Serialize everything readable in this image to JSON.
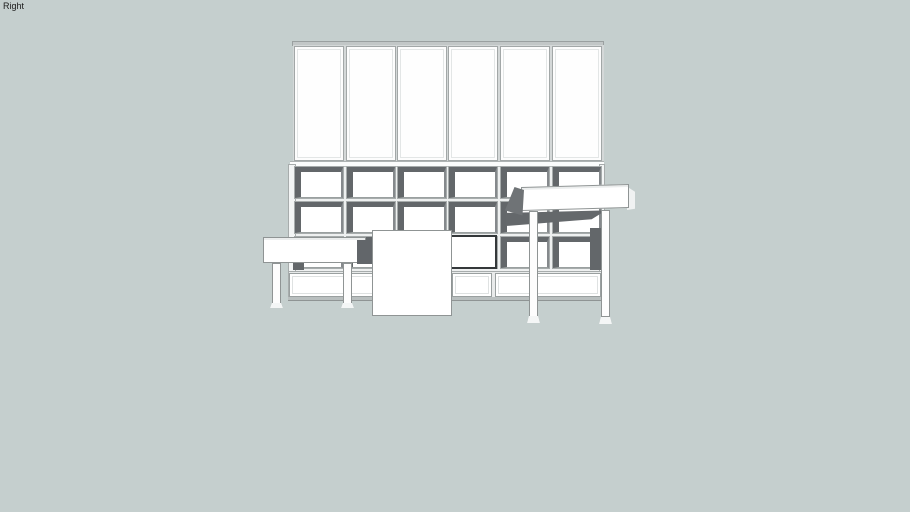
{
  "viewport": {
    "view_label": "Right",
    "background_color": "#c5cfce"
  },
  "model": {
    "name": "modular shelving wall unit with tables",
    "colors": {
      "face": "#ffffff",
      "top_face": "#ececec",
      "shadow": "#63676a",
      "outline": "#8f9494",
      "frame_line": "#a7acac"
    },
    "top_doors": {
      "count": 6
    },
    "cubby_grid": {
      "rows": 3,
      "columns": 6
    },
    "bottom_panels": {
      "count": 3
    },
    "furniture": [
      {
        "name": "left-low-table",
        "legs": 2
      },
      {
        "name": "center-sliding-panel",
        "legs": 0
      },
      {
        "name": "right-table",
        "legs": 2
      }
    ]
  }
}
